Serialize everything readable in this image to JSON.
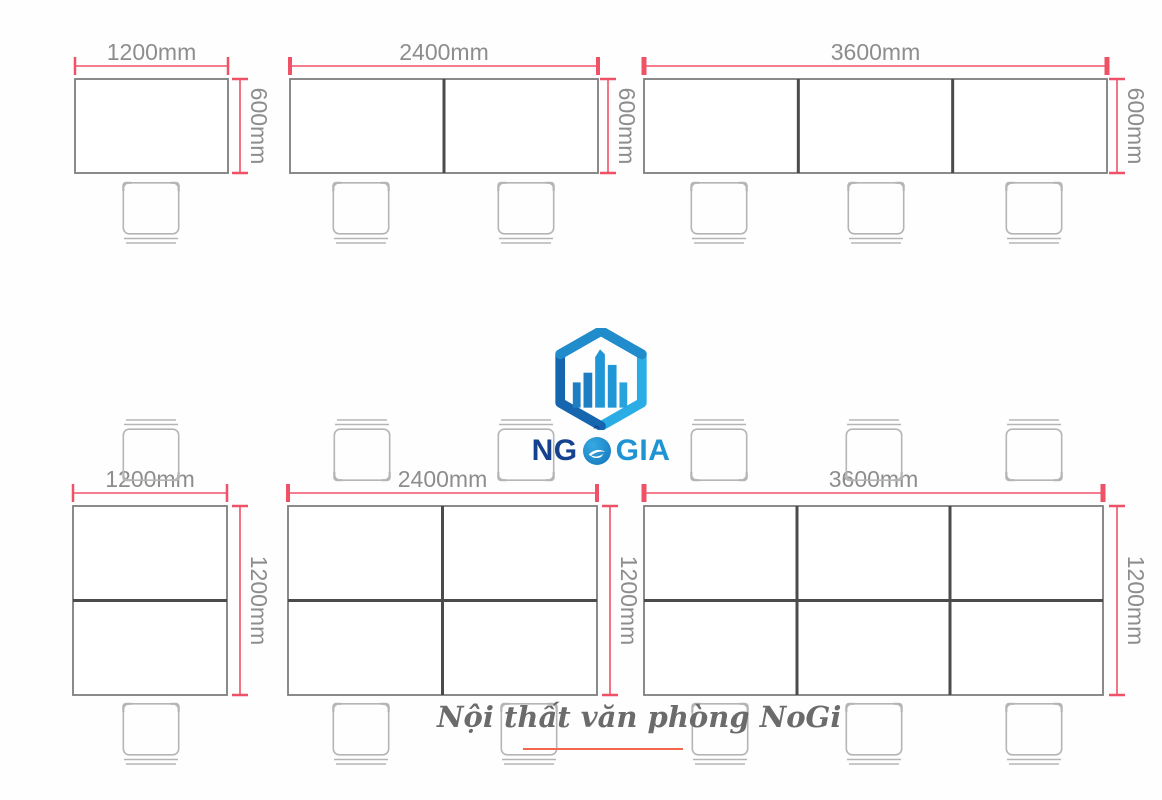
{
  "brand": {
    "name_part_ng": "NG",
    "name_part_o": "Ô",
    "name_part_gia": "GIA",
    "circumflex": "ˆ",
    "logo_icon": "hexagon-city-logo"
  },
  "caption": {
    "text": "Nội thất văn phòng NoGi"
  },
  "colors": {
    "desk_stroke": "#7e7e7e",
    "divider_stroke": "#4b4b4b",
    "chair_stroke": "#b5b5b5",
    "dim_line": "#ef5266",
    "dim_text": "#8d8d8d",
    "logo_dark_blue": "#1566ae",
    "logo_light_blue": "#2aace4",
    "caption_text": "#6b6b6b",
    "underline": "#f2674e"
  },
  "diagram": {
    "units": "mm",
    "desks": [
      {
        "id": "desk-1200x600",
        "width_label": "1200mm",
        "depth_label": "600mm",
        "seats": 1,
        "x": 75,
        "y": 79,
        "w": 153,
        "h": 94,
        "cols": 1,
        "rows": 1,
        "dim_y": 66,
        "tick_w": 2.5,
        "dim_x": 240,
        "chairs_above": [],
        "chairs_below": [
          151
        ],
        "chair_above_y": 0,
        "chair_below_y": 182
      },
      {
        "id": "desk-2400x600",
        "width_label": "2400mm",
        "depth_label": "600mm",
        "seats": 2,
        "x": 290,
        "y": 79,
        "w": 308,
        "h": 94,
        "cols": 2,
        "rows": 1,
        "dim_y": 66,
        "tick_w": 4,
        "dim_x": 608,
        "chairs_above": [],
        "chairs_below": [
          361,
          526
        ],
        "chair_above_y": 0,
        "chair_below_y": 182
      },
      {
        "id": "desk-3600x600",
        "width_label": "3600mm",
        "depth_label": "600mm",
        "seats": 3,
        "x": 644,
        "y": 79,
        "w": 463,
        "h": 94,
        "cols": 3,
        "rows": 1,
        "dim_y": 66,
        "tick_w": 5,
        "dim_x": 1117,
        "chairs_above": [],
        "chairs_below": [
          719,
          876,
          1034
        ],
        "chair_above_y": 0,
        "chair_below_y": 182
      },
      {
        "id": "desk-1200x1200",
        "width_label": "1200mm",
        "depth_label": "1200mm",
        "seats": 2,
        "x": 73,
        "y": 506,
        "w": 154,
        "h": 189,
        "cols": 1,
        "rows": 2,
        "dim_y": 493,
        "tick_w": 2.5,
        "dim_x": 240,
        "chairs_above": [
          151
        ],
        "chairs_below": [
          151
        ],
        "chair_above_y": 419,
        "chair_below_y": 703
      },
      {
        "id": "desk-2400x1200",
        "width_label": "2400mm",
        "depth_label": "1200mm",
        "seats": 4,
        "x": 288,
        "y": 506,
        "w": 309,
        "h": 189,
        "cols": 2,
        "rows": 2,
        "dim_y": 493,
        "tick_w": 4,
        "dim_x": 610,
        "chairs_above": [
          362,
          526
        ],
        "chairs_below": [
          361,
          529
        ],
        "chair_above_y": 419,
        "chair_below_y": 703
      },
      {
        "id": "desk-3600x1200",
        "width_label": "3600mm",
        "depth_label": "1200mm",
        "seats": 6,
        "x": 644,
        "y": 506,
        "w": 459,
        "h": 189,
        "cols": 3,
        "rows": 2,
        "dim_y": 493,
        "tick_w": 5,
        "dim_x": 1117,
        "chairs_above": [
          719,
          874,
          1034
        ],
        "chairs_below": [
          720,
          874,
          1034
        ],
        "chair_above_y": 419,
        "chair_below_y": 703
      }
    ]
  }
}
